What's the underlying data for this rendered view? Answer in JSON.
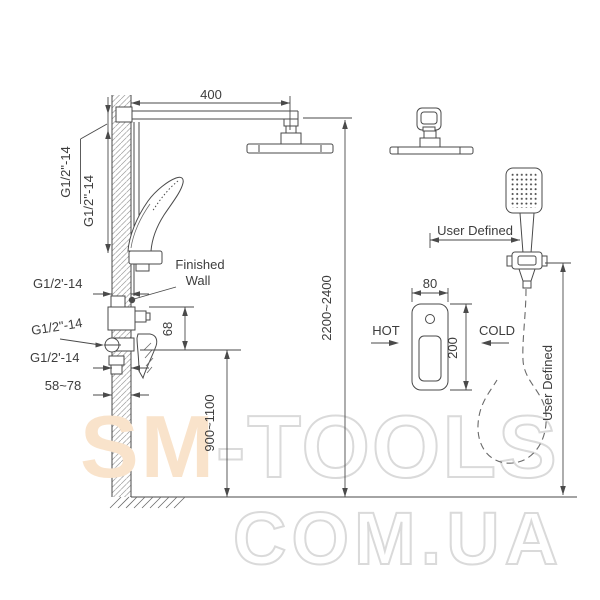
{
  "diagram": {
    "dims": {
      "arm_length": "400",
      "thread_arm": "G1/2\"-14",
      "thread_bar": "G1/2''-14",
      "inlet_top": "G1/2'-14",
      "inlet_mid": "G1/2\"-14",
      "inlet_bottom": "G1/2'-14",
      "embed_depth": "58~78",
      "spout_drop": "68",
      "valve_height": "900~1100",
      "head_height": "2200~2400",
      "box_width": "80",
      "box_height": "200",
      "hand_offset_h": "User Defined",
      "hand_offset_v": "User Defined"
    },
    "labels": {
      "finished_wall_1": "Finished",
      "finished_wall_2": "Wall",
      "hot": "HOT",
      "cold": "COLD"
    }
  },
  "watermark": {
    "brand_left": "SM",
    "brand_right": "-TOOLS",
    "domain": "COM.UA",
    "fill_color": "#f9e3cb",
    "outline_color": "#dadada"
  },
  "colors": {
    "line": "#4a4a4a",
    "text": "#3d3d3d",
    "background": "#ffffff"
  }
}
